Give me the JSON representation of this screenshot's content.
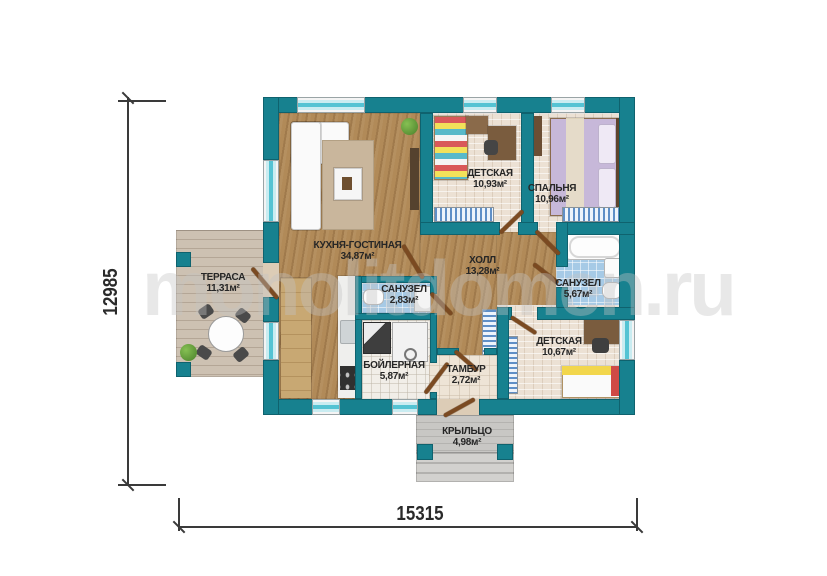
{
  "watermark": {
    "text": "monolitdomen.ru"
  },
  "dimensions": {
    "height_label": "12985",
    "width_label": "15315"
  },
  "rooms": {
    "kitchen_living": {
      "name": "КУХНЯ-ГОСТИНАЯ",
      "area": "34,87м²"
    },
    "children_1": {
      "name": "ДЕТСКАЯ",
      "area": "10,93м²"
    },
    "bedroom": {
      "name": "СПАЛЬНЯ",
      "area": "10,96м²"
    },
    "hall": {
      "name": "ХОЛЛ",
      "area": "13,28м²"
    },
    "bathroom_small": {
      "name": "САНУЗЕЛ",
      "area": "2,83м²"
    },
    "bathroom_big": {
      "name": "САНУЗЕЛ",
      "area": "5,67м²"
    },
    "boiler": {
      "name": "БОЙЛЕРНАЯ",
      "area": "5,87м²"
    },
    "children_2": {
      "name": "ДЕТСКАЯ",
      "area": "10,67м²"
    },
    "tambour": {
      "name": "ТАМБУР",
      "area": "2,72м²"
    },
    "terrace": {
      "name": "ТЕРРАСА",
      "area": "11,31м²"
    },
    "porch": {
      "name": "КРЫЛЬЦО",
      "area": "4,98м²"
    }
  },
  "colors": {
    "wall_teal": "#17818f",
    "window_glass": "#54c3d3",
    "wood_floor": "#b18a58",
    "tile_blue": "#a6cae6",
    "door_brown": "#7b4a21"
  }
}
